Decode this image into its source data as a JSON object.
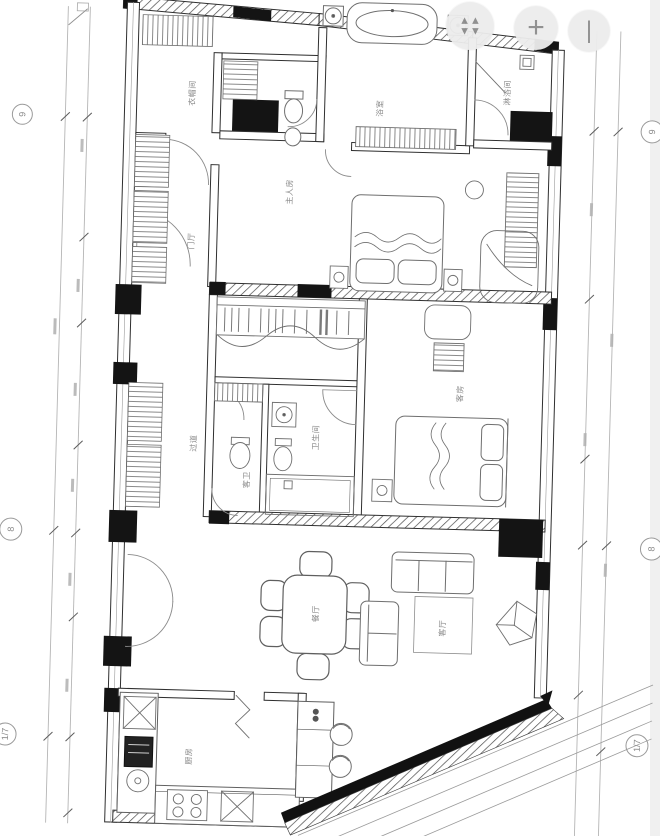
{
  "controls": {
    "zoom_in_glyph": "+",
    "zoom_out_glyph": "|"
  },
  "grid": {
    "left": [
      "9",
      "8",
      "1/7"
    ],
    "right": [
      "9",
      "8",
      "1/7"
    ]
  },
  "rooms": {
    "cloakroom": "衣帽间",
    "master_bedroom": "主人房",
    "bath": "浴室",
    "shower_room": "淋浴间",
    "foyer": "门厅",
    "corridor": "过道",
    "bathroom": "卫生间",
    "guest_bath": "客卫",
    "guest_room": "客房",
    "dining_room": "餐厅",
    "living_room": "客厅",
    "kitchen": "厨房"
  },
  "colors": {
    "wall_fill": "#141414",
    "hatch_line": "#4a4a4a",
    "fixture_line": "#6f6f6f",
    "label_text": "#8a8a8a",
    "bubble_stroke": "#9a9a9a",
    "button_bg": "#ededed",
    "button_glyph": "#8c8c8c"
  }
}
